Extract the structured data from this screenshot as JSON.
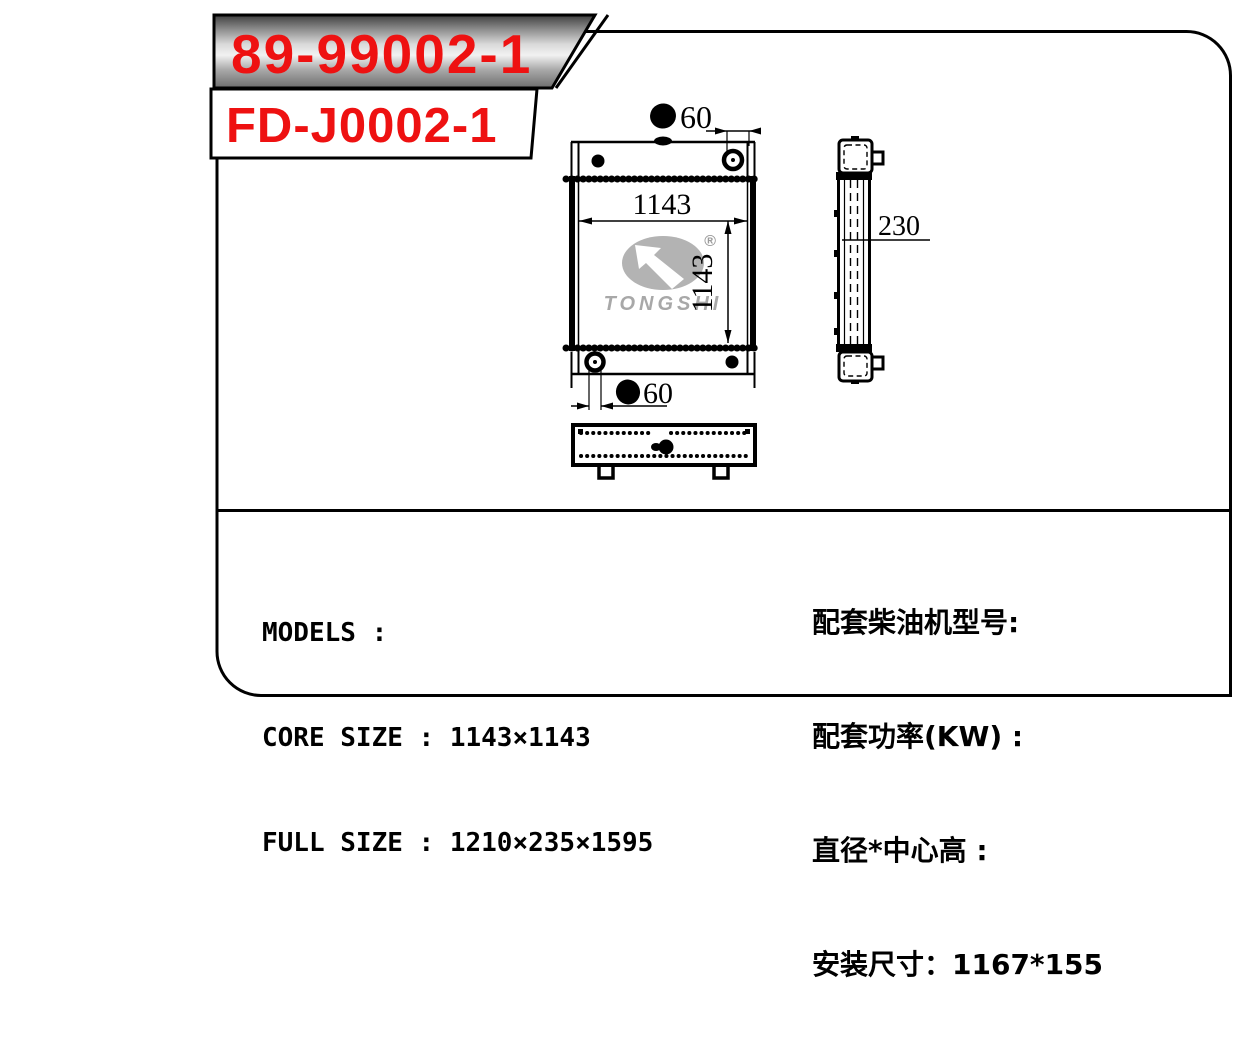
{
  "header": {
    "part_number_plate": "89-99002-1",
    "part_number_tag": "FD-J0002-1"
  },
  "drawing": {
    "front_view": {
      "core_width": "1143",
      "core_height": "1143",
      "top_port_diameter": "60",
      "bottom_port_diameter": "60"
    },
    "side_view": {
      "depth": "230"
    },
    "watermark": {
      "brand": "TONGSHI",
      "registered_mark": "®"
    }
  },
  "specs_en": {
    "models": "MODELS :",
    "core_size": "CORE SIZE : 1143×1143",
    "full_size": "FULL SIZE : 1210×235×1595"
  },
  "specs_cn": {
    "engine_model": "配套柴油机型号:",
    "power_kw": "配套功率(KW) :",
    "dia_center_height": "直径*中心高 :",
    "mounting_size": "安装尺寸：1167*155"
  },
  "colors": {
    "accent_red": "#ee1111",
    "line": "#000000",
    "watermark_gray": "#adadad"
  }
}
